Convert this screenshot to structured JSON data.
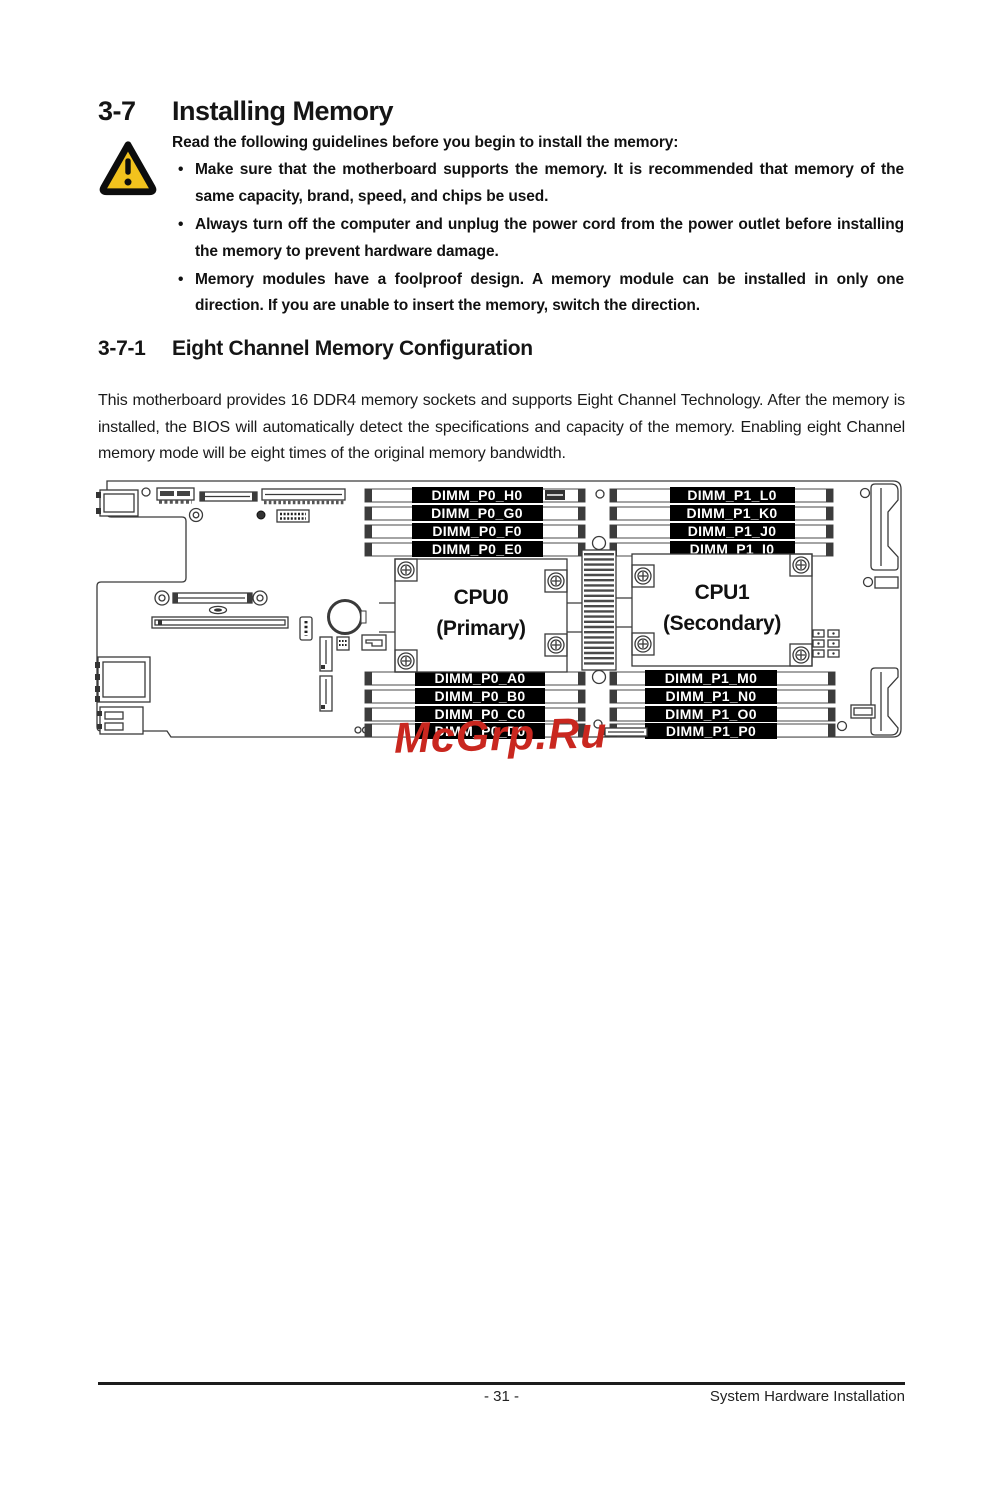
{
  "header": {
    "section_no": "3-7",
    "title": "Installing Memory"
  },
  "guidelines": {
    "intro": "Read the following guidelines before you begin to install the memory:",
    "bullets": [
      "Make sure that the motherboard supports the memory. It is recommended that memory of the same capacity, brand, speed, and chips be used.",
      "Always turn off the computer and unplug the power cord from the power outlet before installing the memory to prevent hardware damage.",
      "Memory modules have a foolproof design. A memory module can be installed in only one direction. If you are unable to insert the memory, switch the direction."
    ]
  },
  "subsection": {
    "section_no": "3-7-1",
    "title": "Eight Channel Memory Configuration"
  },
  "body": "This motherboard provides 16 DDR4 memory sockets and supports Eight Channel Technology. After the memory is installed, the BIOS will automatically detect the specifications and capacity of the memory. Enabling eight Channel memory mode will be eight times of the original memory bandwidth.",
  "diagram": {
    "cpu0_title": "CPU0",
    "cpu0_sub": "(Primary)",
    "cpu1_title": "CPU1",
    "cpu1_sub": "(Secondary)",
    "dimm_p0_top": [
      "DIMM_P0_H0",
      "DIMM_P0_G0",
      "DIMM_P0_F0",
      "DIMM_P0_E0"
    ],
    "dimm_p1_top": [
      "DIMM_P1_L0",
      "DIMM_P1_K0",
      "DIMM_P1_J0",
      "DIMM_P1_I0"
    ],
    "dimm_p0_bottom": [
      "DIMM_P0_A0",
      "DIMM_P0_B0",
      "DIMM_P0_C0",
      "DIMM_P0_D0"
    ],
    "dimm_p1_bottom": [
      "DIMM_P1_M0",
      "DIMM_P1_N0",
      "DIMM_P1_O0",
      "DIMM_P1_P0"
    ]
  },
  "watermark": "McGrp.Ru",
  "footer": {
    "page_number": "- 31 -",
    "right_text": "System Hardware Installation"
  },
  "colors": {
    "warning_yellow": "#F2C21D",
    "watermark_red": "#C9271F",
    "label_bg": "#000000",
    "label_fg": "#FFFFFF"
  }
}
